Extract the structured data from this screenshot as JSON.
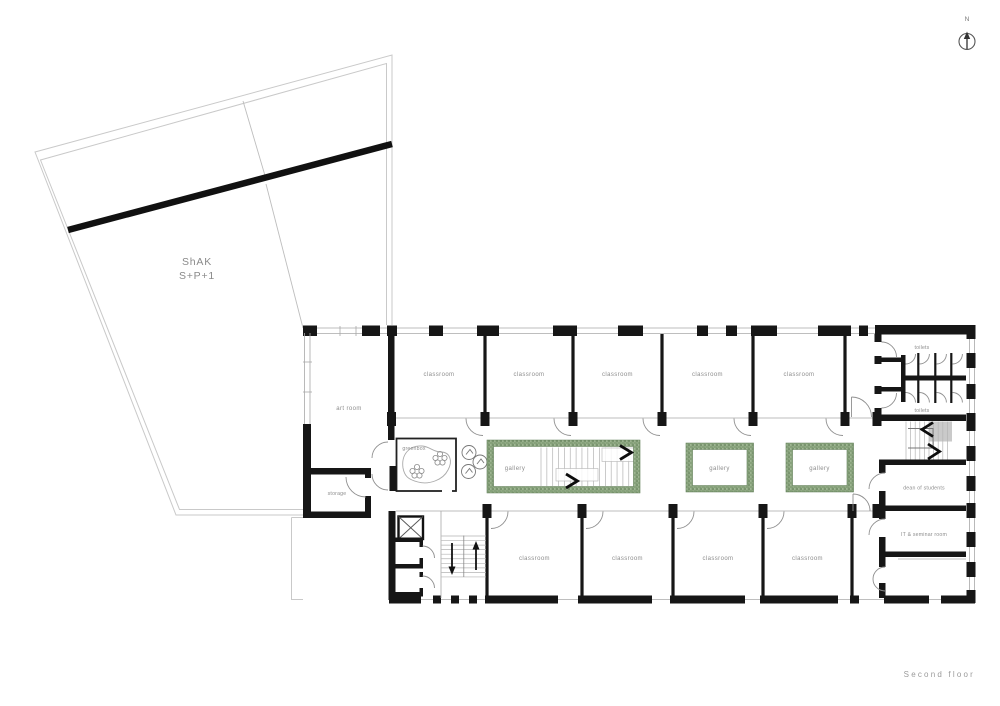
{
  "page": {
    "floor_label": "Second floor",
    "north_label": "N"
  },
  "shak": {
    "line1": "ShAK",
    "line2": "S+P+1"
  },
  "rooms": {
    "art_room": "art room",
    "storage": "storage",
    "greenbox": "greenbox",
    "gallery_main": "gallery",
    "gallery_small_a": "gallery",
    "gallery_small_b": "gallery",
    "toilets_top": "toilets",
    "toilets_bottom": "toilets",
    "dean": "dean of students",
    "it_seminar": "IT & seminar room",
    "classrooms_top": [
      "classroom",
      "classroom",
      "classroom",
      "classroom",
      "classroom"
    ],
    "classrooms_bottom": [
      "classroom",
      "classroom",
      "classroom",
      "classroom"
    ]
  },
  "colors": {
    "wall": "#161616",
    "label": "#8d8d8d",
    "gallery_green": "#7e9c72",
    "site_outline": "#c9c9c9"
  }
}
